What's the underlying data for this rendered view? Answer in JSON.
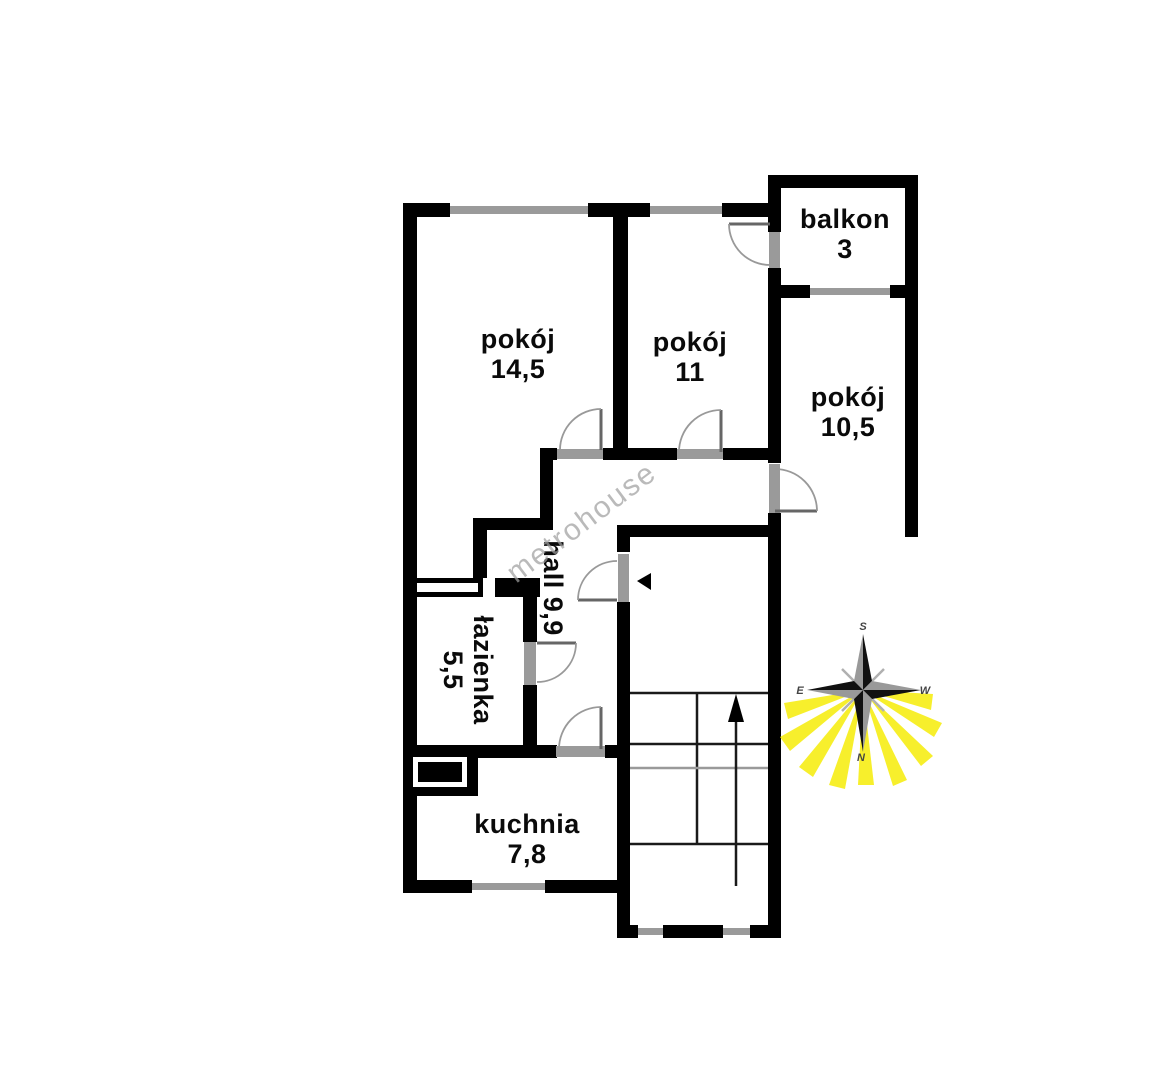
{
  "watermark": "metrohouse",
  "rooms": [
    {
      "name": "pokoj-14-5",
      "label": "pokój",
      "area": "14,5"
    },
    {
      "name": "pokoj-11",
      "label": "pokój",
      "area": "11"
    },
    {
      "name": "pokoj-10-5",
      "label": "pokój",
      "area": "10,5"
    },
    {
      "name": "balkon",
      "label": "balkon",
      "area": "3"
    },
    {
      "name": "hall",
      "label": "hall",
      "area": "9,9"
    },
    {
      "name": "lazienka",
      "label": "łazienka",
      "area": "5,5"
    },
    {
      "name": "kuchnia",
      "label": "kuchnia",
      "area": "7,8"
    }
  ],
  "compass": {
    "top": "S",
    "bottom": "N",
    "left": "E",
    "right": "W"
  },
  "colors": {
    "wall": "#000000",
    "window": "#9a9a9a",
    "door_sill": "#9a9a9a",
    "door_arc": "#999999",
    "sun_ray": "#f6ed0f",
    "star_dark": "#111111",
    "star_light": "#999999",
    "watermark": "#a0a0a0"
  }
}
